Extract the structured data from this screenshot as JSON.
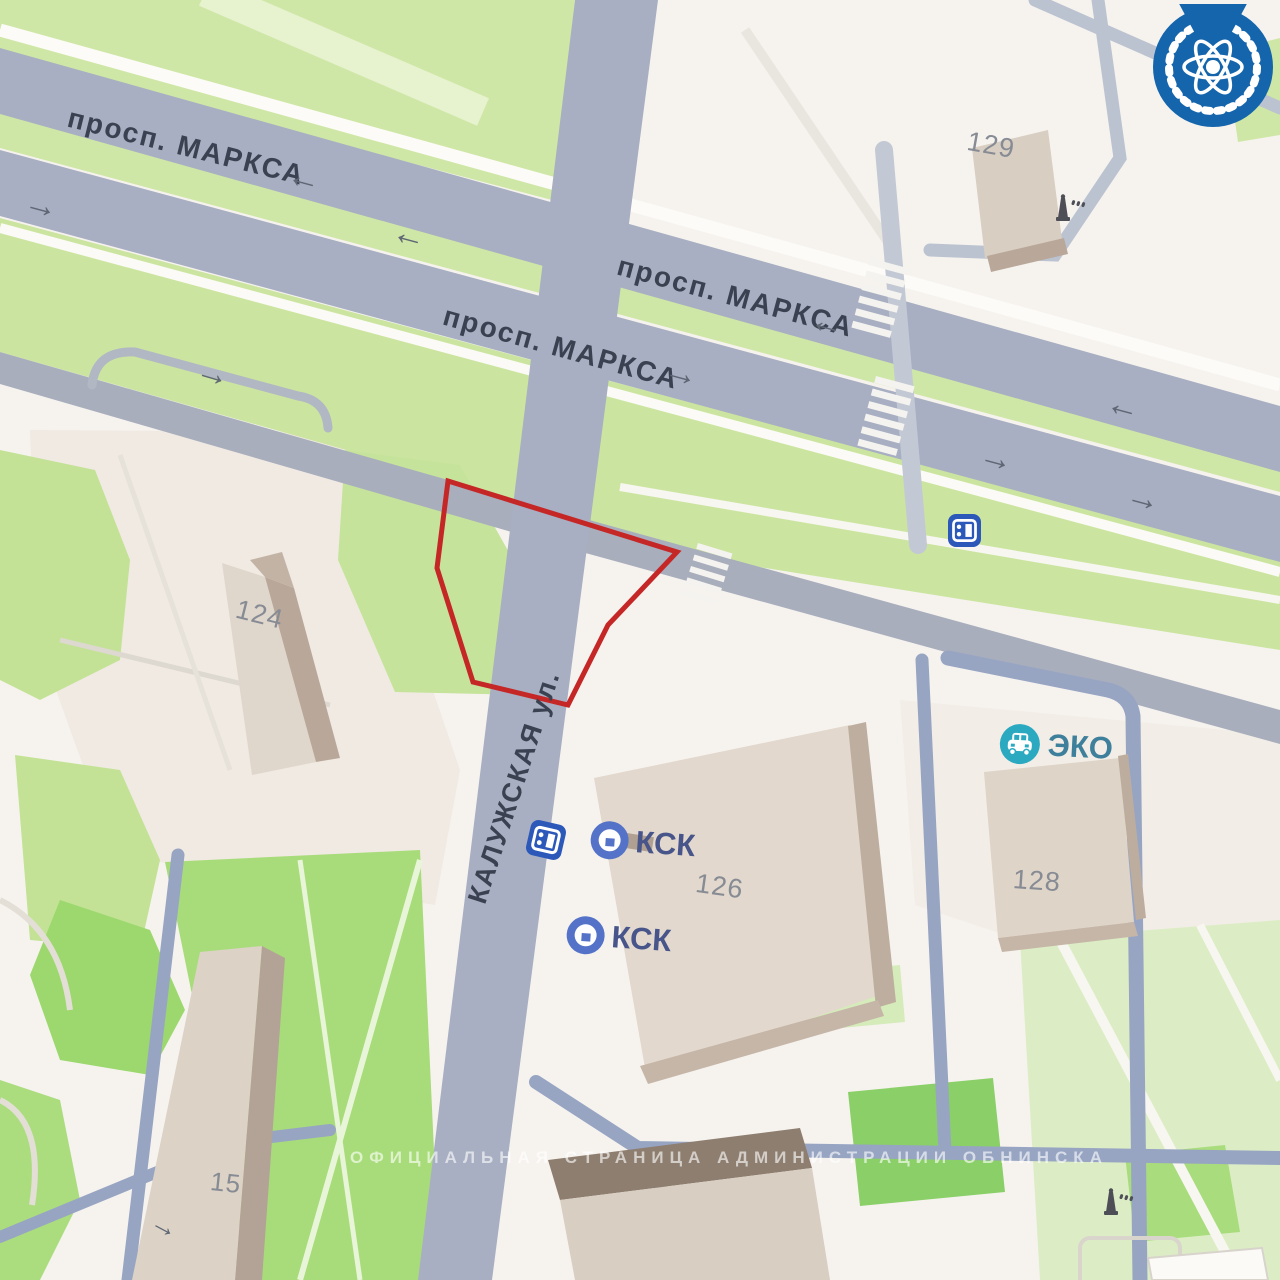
{
  "map": {
    "street_labels": [
      {
        "id": "marx-top-left",
        "text": "просп. МАРКСА"
      },
      {
        "id": "marx-center-upper",
        "text": "просп. МАРКСА"
      },
      {
        "id": "marx-center-lower",
        "text": "просп. МАРКСА"
      },
      {
        "id": "kaluzhskaya",
        "text": "КАЛУЖСКАЯ ул."
      }
    ],
    "road_arrows": [
      {
        "direction": "left",
        "glyph": "←"
      },
      {
        "direction": "right",
        "glyph": "→"
      },
      {
        "direction": "left",
        "glyph": "←"
      },
      {
        "direction": "left",
        "glyph": "←"
      },
      {
        "direction": "right",
        "glyph": "→"
      },
      {
        "direction": "left",
        "glyph": "←"
      },
      {
        "direction": "right",
        "glyph": "→"
      },
      {
        "direction": "right",
        "glyph": "→"
      },
      {
        "direction": "right",
        "glyph": "→"
      },
      {
        "direction": "right",
        "glyph": "→"
      }
    ],
    "building_numbers": [
      "129",
      "124",
      "126",
      "128",
      "15"
    ],
    "pois": [
      {
        "label": "КСК",
        "icon": "kck-circle-icon"
      },
      {
        "label": "КСК",
        "icon": "kck-circle-icon"
      },
      {
        "label": "ЭКО",
        "icon": "car-service-icon"
      }
    ],
    "transit_stops": [
      {
        "icon": "bus-stop-icon",
        "location": "kaluzhskaya-street"
      },
      {
        "icon": "bus-stop-icon",
        "location": "marx-avenue"
      }
    ],
    "monuments": [
      {
        "icon": "monument-icon",
        "location": "near-building-129"
      },
      {
        "icon": "monument-icon",
        "location": "bottom-right"
      }
    ],
    "watermark": "ОФИЦИАЛЬНАЯ СТРАНИЦА АДМИНИСТРАЦИИ ОБНИНСКА",
    "logo": {
      "name": "obninsk-administration-emblem"
    },
    "highlight_area": {
      "shape": "red-outline-polygon",
      "stroke": "#c52727"
    },
    "colors": {
      "background": "#f6f3ef",
      "road": "#a8afc2",
      "driveway": "#97a5c3",
      "park": "#cfe7a6",
      "lawn": "#a8dc7a",
      "building_face": "#ddd3c6",
      "building_shadow": "#b9a89a",
      "highlight": "#c52727",
      "logo_blue": "#1565ad",
      "poi_blue": "#5472c8",
      "poi_teal": "#2ba9c1"
    }
  }
}
